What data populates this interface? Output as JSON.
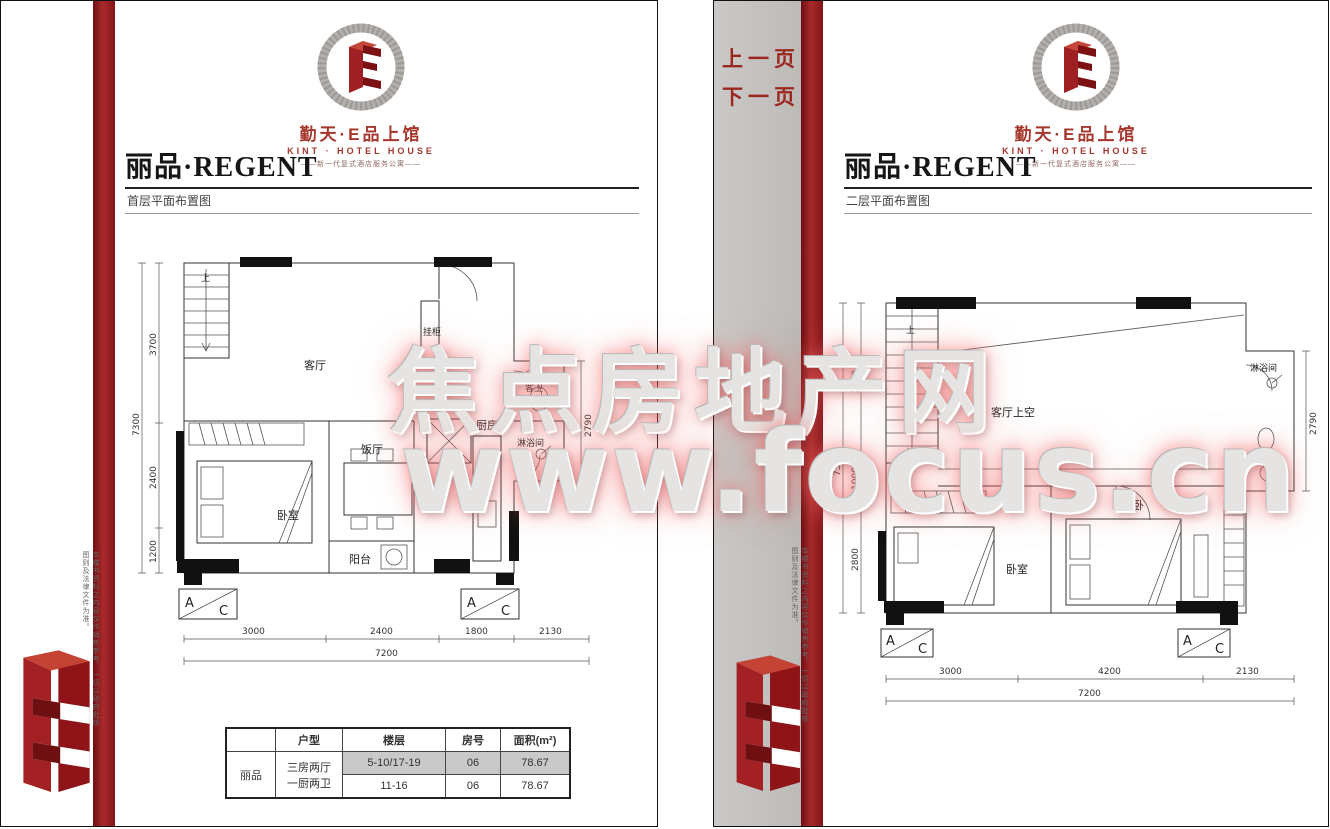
{
  "watermark": {
    "line1": "焦点房地产网",
    "line2": "www.focus.cn"
  },
  "nav": {
    "prev": "上一页",
    "next": "下一页"
  },
  "brand": {
    "name_cn": "勤天·E品上馆",
    "name_en": "KINT · HOTEL HOUSE",
    "tagline": "——新一代复式酒店服务公寓——"
  },
  "sidebar_note": "本楼书资料之内容仅作销售参考，一切以政府批核图则及法律文件为准。",
  "pages": [
    {
      "title": "丽品·REGENT",
      "subtitle": "首层平面布置图",
      "plan": {
        "up_label": "上",
        "rooms": [
          "客厅",
          "挂柜",
          "客卫",
          "淋浴间",
          "饭厅",
          "厨房",
          "卧室",
          "阳台"
        ],
        "ac": [
          "A",
          "C"
        ],
        "dims_left": [
          "3700",
          "2400",
          "1200"
        ],
        "left_total": "7300",
        "dims_bottom": [
          "3000",
          "2400",
          "1800",
          "2130"
        ],
        "bottom_total": "7200",
        "dim_right": "2790"
      }
    },
    {
      "title": "丽品·REGENT",
      "subtitle": "二层平面布置图",
      "plan": {
        "up_label": "上",
        "rooms": [
          "客厅上空",
          "淋浴间",
          "主卫",
          "卧室",
          "主卧"
        ],
        "ac": [
          "A",
          "C"
        ],
        "dims_left": [
          "3500",
          "1000",
          "2800"
        ],
        "left_total": "7300",
        "dims_bottom": [
          "3000",
          "4200",
          "2130"
        ],
        "bottom_total": "7200",
        "dim_right": "2790"
      }
    }
  ],
  "unit_table": {
    "group_label": "丽品",
    "headers": [
      "户型",
      "楼层",
      "房号",
      "面积(m²)"
    ],
    "unit_type_lines": [
      "三房两厅",
      "一厨两卫"
    ],
    "rows": [
      [
        "5-10/17-19",
        "06",
        "78.67"
      ],
      [
        "11-16",
        "06",
        "78.67"
      ]
    ]
  }
}
